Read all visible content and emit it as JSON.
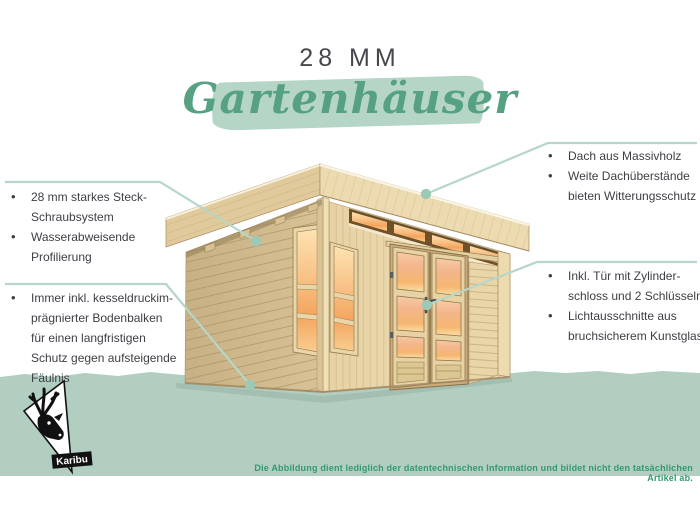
{
  "title": {
    "size_label": "28 MM",
    "script_label": "Gartenhäuser"
  },
  "callouts": {
    "left_top": {
      "items": [
        "28 mm starkes Steck-\nSchraubsystem",
        "Wasserabweisende\nProfilierung"
      ]
    },
    "left_bottom": {
      "items": [
        "Immer inkl. kesseldruckim-\nprägnierter Bodenbalken\nfür einen langfristigen\nSchutz gegen aufsteigende\nFäulnis"
      ]
    },
    "right_top": {
      "items": [
        "Dach aus Massivholz",
        "Weite Dachüberstände\nbieten Witterungsschutz"
      ]
    },
    "right_bottom": {
      "items": [
        "Inkl. Tür mit Zylinder-\nschloss und 2 Schlüsseln",
        "Lichtausschnitte aus\nbruchsicherem Kunstglas"
      ]
    }
  },
  "footer": {
    "disclaimer": "Die Abbildung dient lediglich der datentechnischen Information und bildet nicht den tatsächlichen Artikel ab."
  },
  "logo": {
    "label": "Karibu",
    "icon": "deer-head-icon"
  },
  "colors": {
    "accent_green": "#57a183",
    "highlight_green": "#b5d6c6",
    "band_green": "#b1cec1",
    "callout_line": "#b6d6c7",
    "callout_dot": "#9ccab6",
    "text_dark": "#3e3e45",
    "disclaimer_green": "#33996f",
    "wood_light": "#ead7ab",
    "wood_shaded": "#cfb98c",
    "window_amber": "#f3a55e"
  }
}
